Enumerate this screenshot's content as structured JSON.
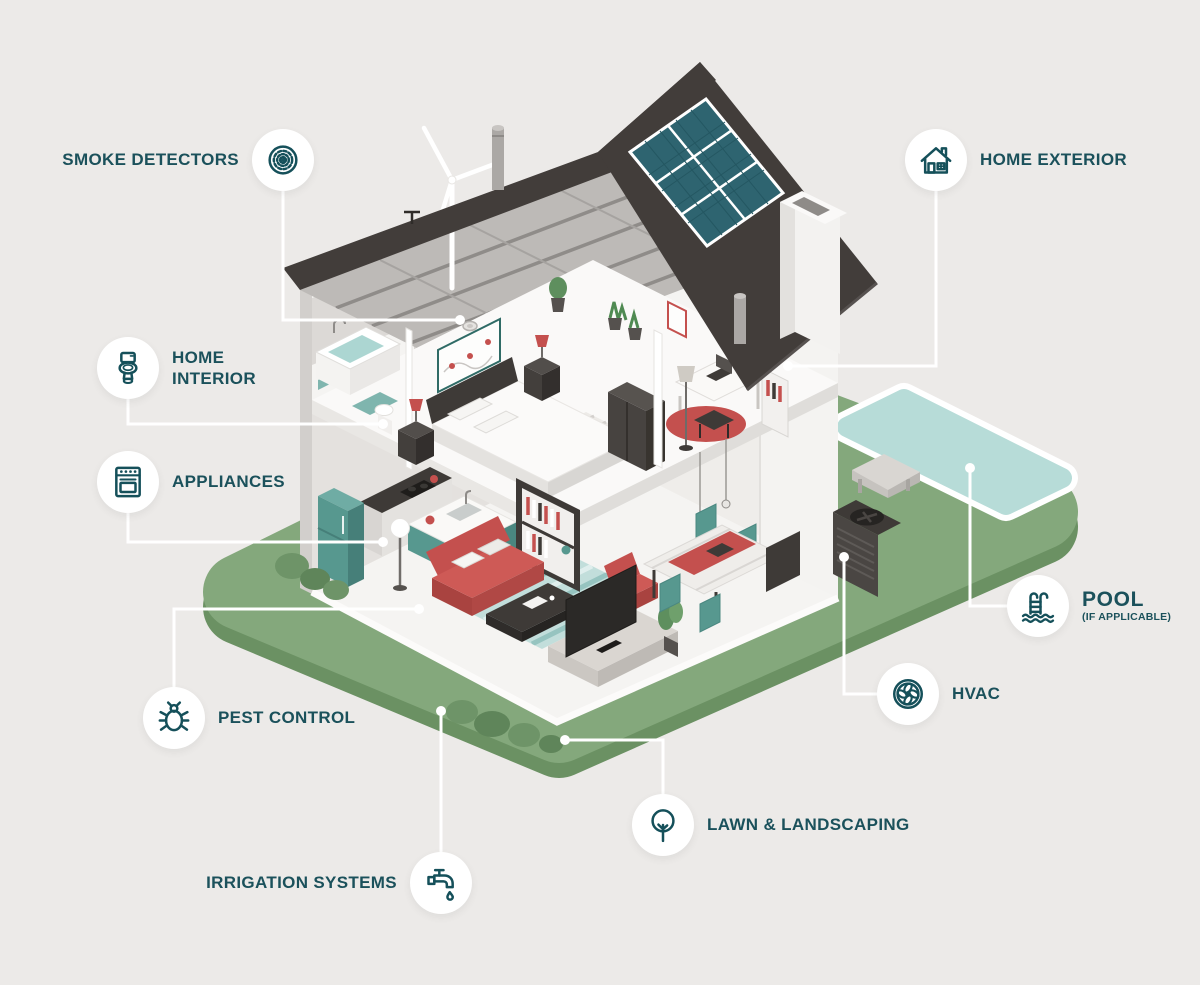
{
  "title": "Home inspection areas infographic",
  "colors": {
    "background": "#ECEAE8",
    "label_text": "#1B515B",
    "icon_stroke": "#15505A",
    "connector": "#FFFFFF",
    "lawn": "#84A87C",
    "lawn_side": "#6B9163",
    "pool_water": "#B7DCD8",
    "roof": "#423D3A",
    "solar_panel": "#2E6470",
    "accent_red": "#C4504E",
    "furniture_teal": "#57988F",
    "furniture_dark": "#3E3A37"
  },
  "callouts": [
    {
      "label": "SMOKE DETECTORS",
      "icon": "smoke-detector-icon"
    },
    {
      "label": "HOME EXTERIOR",
      "icon": "house-icon"
    },
    {
      "label": "HOME INTERIOR",
      "icon": "toilet-icon"
    },
    {
      "label": "APPLIANCES",
      "icon": "oven-icon"
    },
    {
      "label": "PEST CONTROL",
      "icon": "bug-icon"
    },
    {
      "label": "IRRIGATION SYSTEMS",
      "icon": "faucet-icon"
    },
    {
      "label": "LAWN & LANDSCAPING",
      "icon": "tree-icon"
    },
    {
      "label": "HVAC",
      "icon": "fan-icon"
    },
    {
      "label": "POOL",
      "sublabel": "(IF APPLICABLE)",
      "icon": "pool-ladder-icon"
    }
  ],
  "scene": {
    "type": "isometric-cutaway-house",
    "elements": [
      "lawn",
      "pool",
      "pool-bench",
      "roof",
      "solar-panels",
      "chimney",
      "wind-turbine",
      "roof-vents",
      "attic-ceiling",
      "bathroom",
      "bedroom",
      "home-office",
      "kitchen",
      "living-room",
      "dining-area",
      "hvac-unit",
      "bushes",
      "smoke-detector-device"
    ]
  }
}
